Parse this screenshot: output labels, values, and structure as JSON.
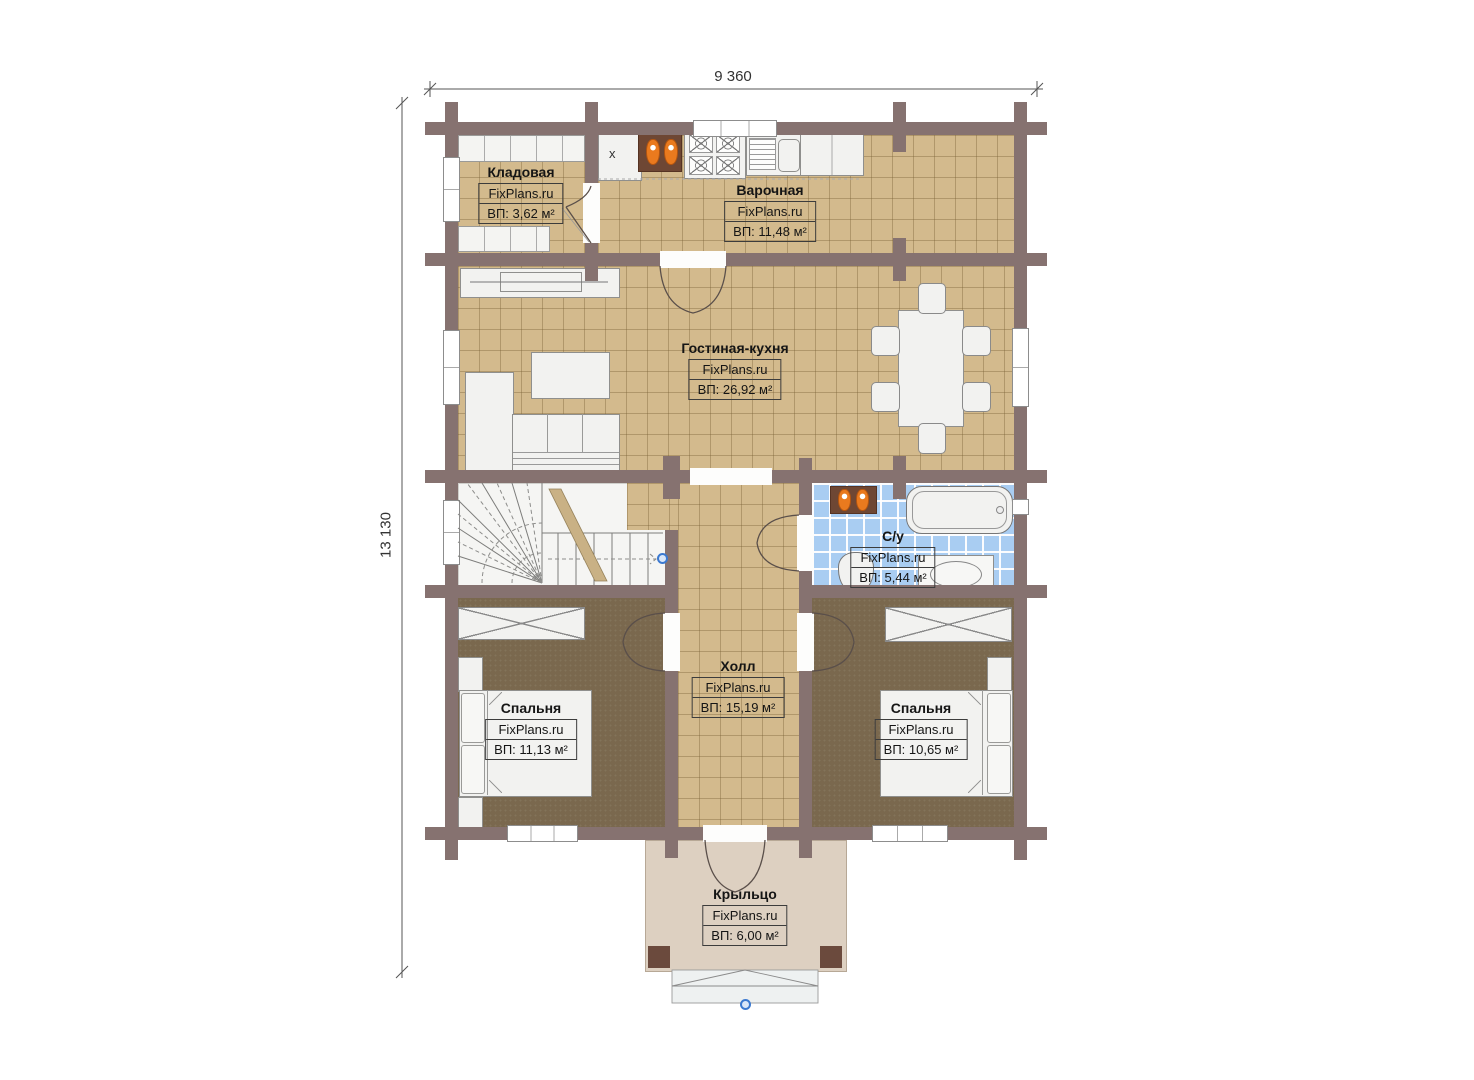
{
  "dimensions": {
    "width_label": "9 360",
    "height_label": "13 130"
  },
  "rooms": {
    "kladovaya": {
      "name": "Кладовая",
      "brand": "FixPlans.ru",
      "area": "ВП: 3,62 м²"
    },
    "varochnaya": {
      "name": "Варочная",
      "brand": "FixPlans.ru",
      "area": "ВП: 11,48 м²"
    },
    "gostinaya": {
      "name": "Гостиная-кухня",
      "brand": "FixPlans.ru",
      "area": "ВП: 26,92 м²"
    },
    "sanuzel": {
      "name": "С/у",
      "brand": "FixPlans.ru",
      "area": "ВП: 5,44 м²"
    },
    "holl": {
      "name": "Холл",
      "brand": "FixPlans.ru",
      "area": "ВП: 15,19 м²"
    },
    "spalnya_left": {
      "name": "Спальня",
      "brand": "FixPlans.ru",
      "area": "ВП: 11,13 м²"
    },
    "spalnya_right": {
      "name": "Спальня",
      "brand": "FixPlans.ru",
      "area": "ВП: 10,65 м²"
    },
    "kryltso": {
      "name": "Крыльцо",
      "brand": "FixPlans.ru",
      "area": "ВП: 6,00 м²"
    }
  },
  "marks": {
    "counter_x": "x"
  },
  "colors": {
    "wall": "#867270",
    "floor_tile": "#d3ba8d",
    "bedroom_floor": "#7a684e",
    "bathroom_tile": "#a9cdf2",
    "porch": "#ddd0c1",
    "accent_orange": "#ea7a1e",
    "handle_blue": "#3b79d0"
  }
}
